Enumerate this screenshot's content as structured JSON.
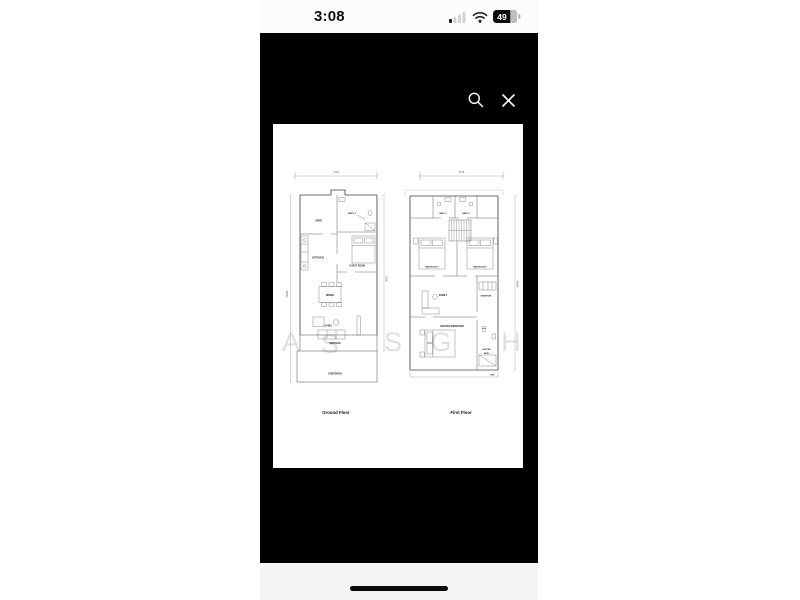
{
  "status_bar": {
    "time": "3:08",
    "battery_percent": "49"
  },
  "floorplan": {
    "watermark": [
      "A",
      "S",
      "S",
      "G",
      "H"
    ],
    "ground": {
      "title": "Ground Floor",
      "dim_top": "4715",
      "dim_left": "12040",
      "dim_right": "3925",
      "rooms": {
        "yard": "YARD",
        "bath": "BATH 3",
        "kitchen": "KITCHEN",
        "guest": "GUEST ROOM",
        "dining": "DINING",
        "living": "LIVING",
        "terrace": "TERRACE",
        "carporch": "CARPORCH"
      }
    },
    "first": {
      "title": "First Floor",
      "dim_top": "4715",
      "dim_right": "12040",
      "rooms": {
        "bath3": "BATH 3",
        "bath2": "BATH 2",
        "bedroom3": "BEDROOM 3",
        "bedroom2": "BEDROOM 2",
        "family": "FAMILY",
        "wardrobe": "WARDROBE",
        "master": "MASTER BEDROOM",
        "masterbath_line1": "MASTER",
        "masterbath_line2": "BATH",
        "void": "VOID"
      }
    }
  }
}
